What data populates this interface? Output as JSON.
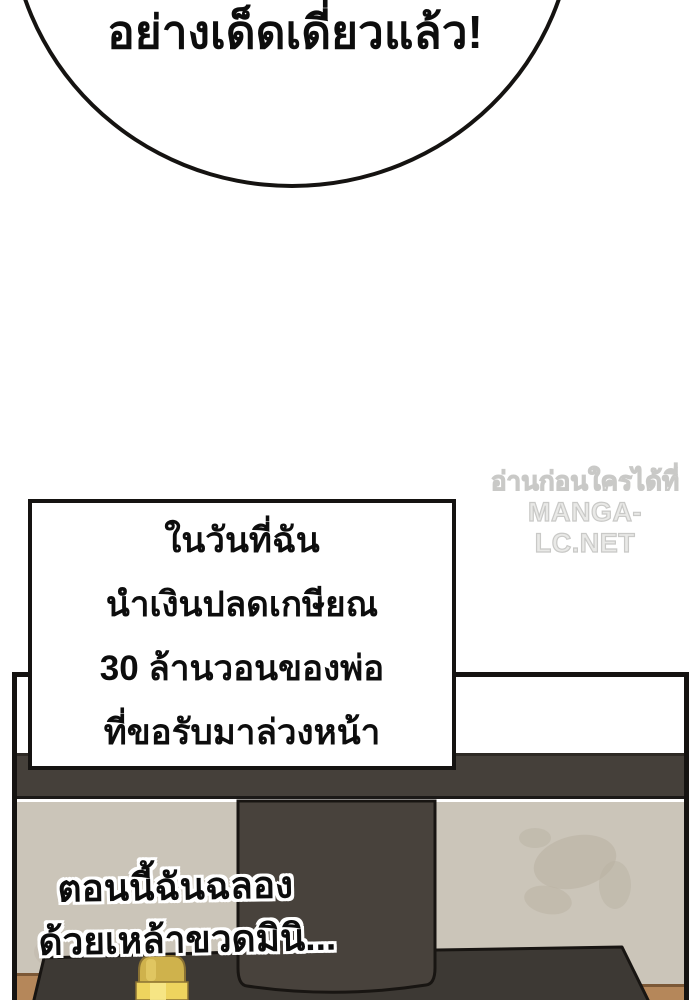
{
  "speech_bubble": {
    "text": "อย่างเด็ดเดี่ยวแล้ว!"
  },
  "watermark": {
    "line1": "อ่านก่อนใครได้ที่",
    "line2": "MANGA-LC.NET"
  },
  "narration_box": {
    "lines": [
      "ในวันที่ฉัน",
      "นำเงินปลดเกษียณ",
      "30 ล้านวอนของพ่อ",
      "ที่ขอรับมาล่วงหน้า"
    ]
  },
  "caption": {
    "lines": [
      "ตอนนี้ฉันฉลอง",
      "ด้วยเหล้าขวดมินิ..."
    ]
  },
  "colors": {
    "ink": "#151311",
    "furniture_dark": "#45403a",
    "column_dark": "#48423c",
    "table_dark": "#3d3934",
    "wall_beige": "#cbc5b9",
    "stain": "#b9b1a2",
    "wood_floor": "#b5875a",
    "bottle_gold": "#cfb24c",
    "bottle_gold_light": "#eed45e",
    "watermark_gray": "#e9e9e7"
  }
}
